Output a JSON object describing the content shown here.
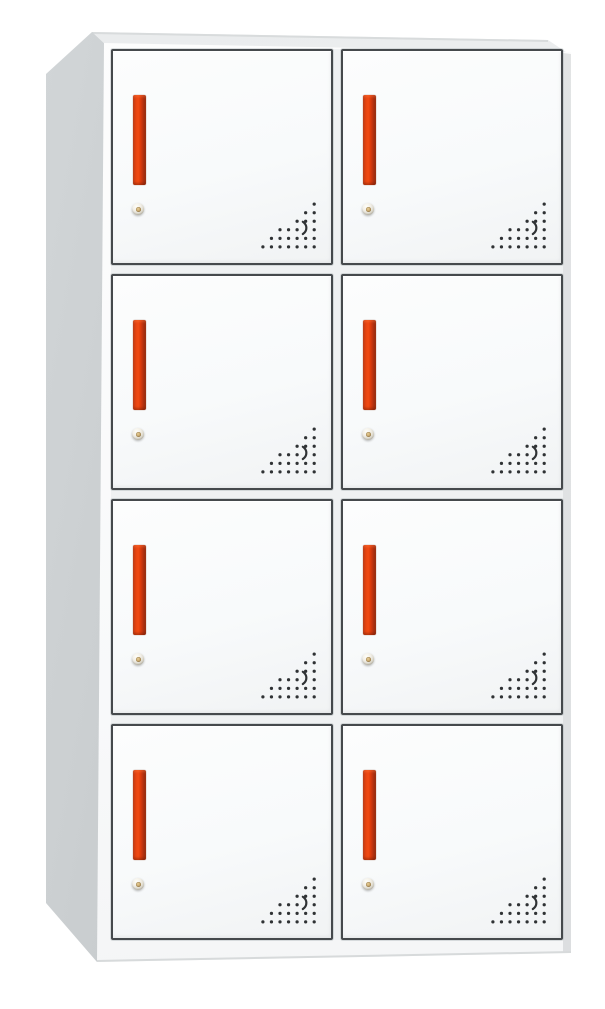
{
  "scene": {
    "description": "Product photo of a white eight-door steel locker cabinet with red vertical handles, round cam locks and perforated corner vent holes, shown in slight left perspective on a white background",
    "background_color": "#ffffff"
  },
  "locker": {
    "rows": 4,
    "columns": 2,
    "door_count": 8,
    "door_label": "Locker door",
    "handle_label": "Red vertical door handle",
    "lock_label": "Round cam lock with keyhole",
    "vents_label": "Perforated ventilation holes",
    "colors": {
      "door_face": "#f8fafb",
      "door_frame": "#45494c",
      "side_panel": "#c6cacc",
      "top_panel": "#f2f4f5",
      "handle_red": "#e8430f",
      "handle_red_dark": "#8f280e",
      "lock_silver": "#e5e2d8",
      "lock_gold": "#c5a468",
      "vent_dot": "#2f3234"
    }
  }
}
